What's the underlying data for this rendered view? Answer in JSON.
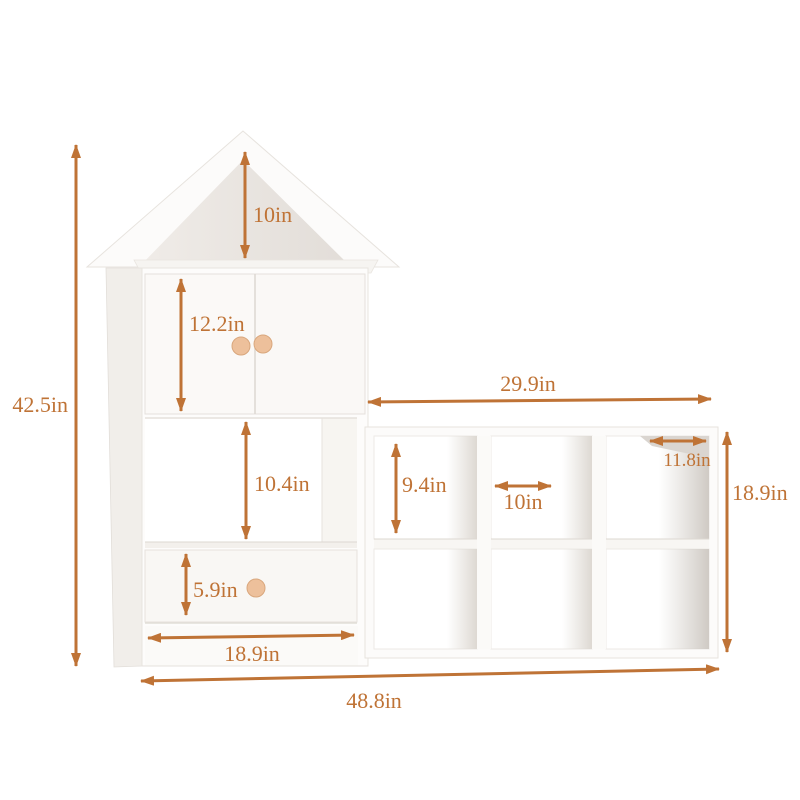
{
  "diagram": {
    "accent_color": "#bf7336",
    "knob_color": "#edc09b",
    "dimensions": {
      "total_height": "42.5in",
      "roof_interior_height": "10in",
      "door_height": "12.2in",
      "open_shelf_height": "10.4in",
      "drawer_height": "5.9in",
      "house_width": "18.9in",
      "cube_unit_width": "29.9in",
      "cube_opening_height": "9.4in",
      "cube_opening_width": "10in",
      "cube_depth": "11.8in",
      "cube_unit_height": "18.9in",
      "total_width": "48.8in"
    }
  }
}
